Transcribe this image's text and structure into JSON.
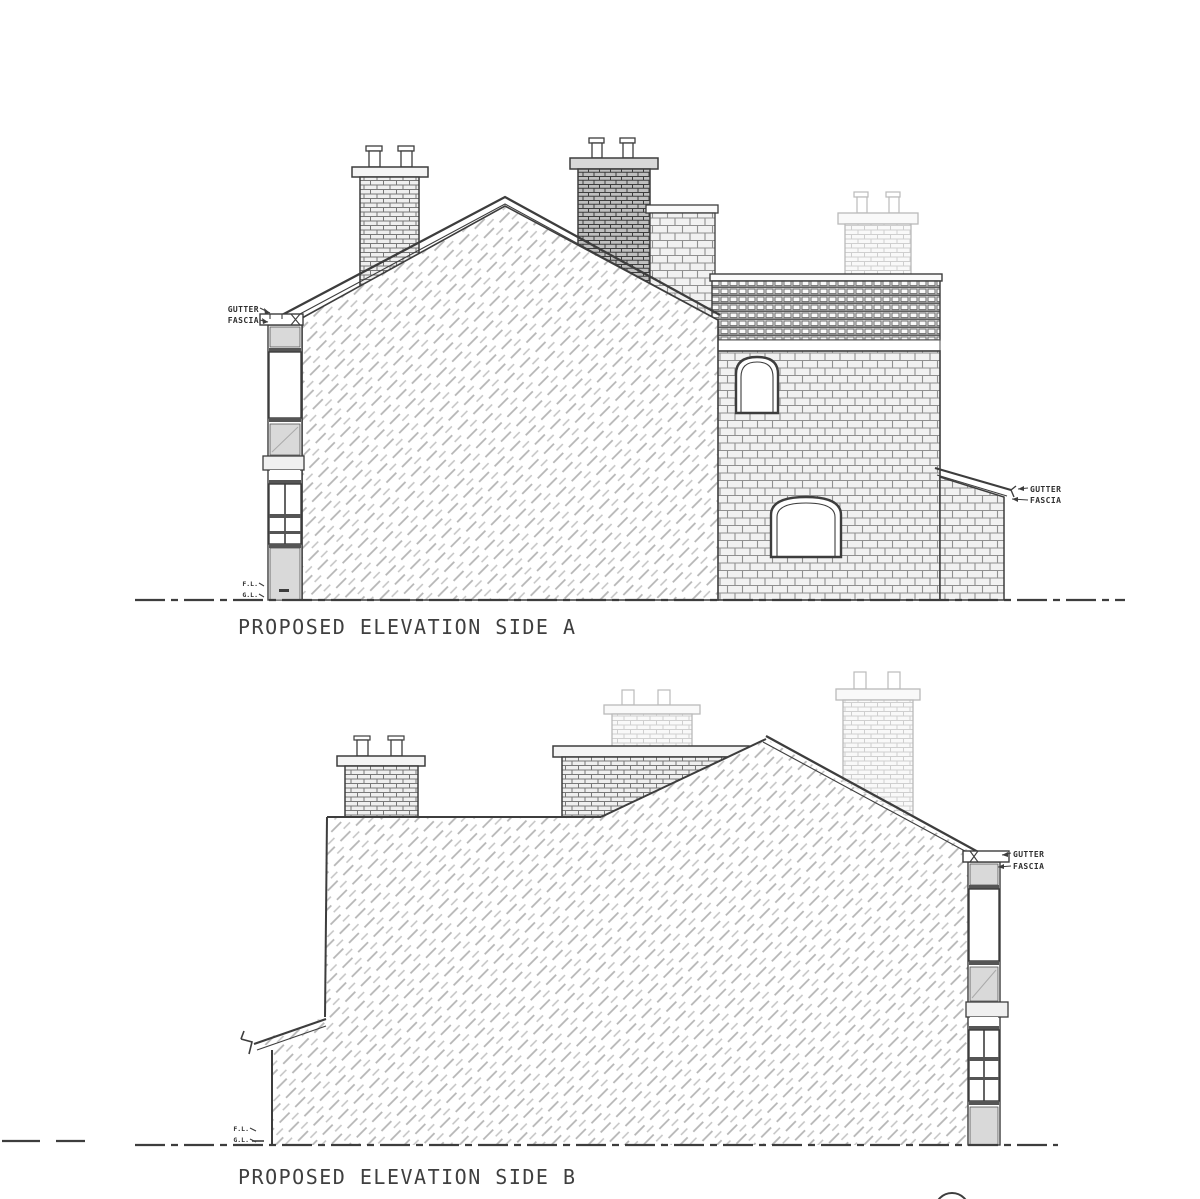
{
  "drawing": {
    "background_color": "#ffffff",
    "line_color": "#3d3d3d",
    "hatch_color": "#b5b5b5",
    "panel_color": "#d9d9d9"
  },
  "elevation_a": {
    "title": "PROPOSED ELEVATION SIDE A",
    "labels": {
      "gutter_left": "GUTTER",
      "fascia_left": "FASCIA",
      "gutter_right": "GUTTER",
      "fascia_right": "FASCIA",
      "floor_level": "F.L.",
      "ground_level": "G.L."
    }
  },
  "elevation_b": {
    "title": "PROPOSED ELEVATION SIDE B",
    "labels": {
      "gutter_right": "GUTTER",
      "fascia_right": "FASCIA",
      "floor_level": "F.L.",
      "ground_level": "G.L."
    }
  }
}
